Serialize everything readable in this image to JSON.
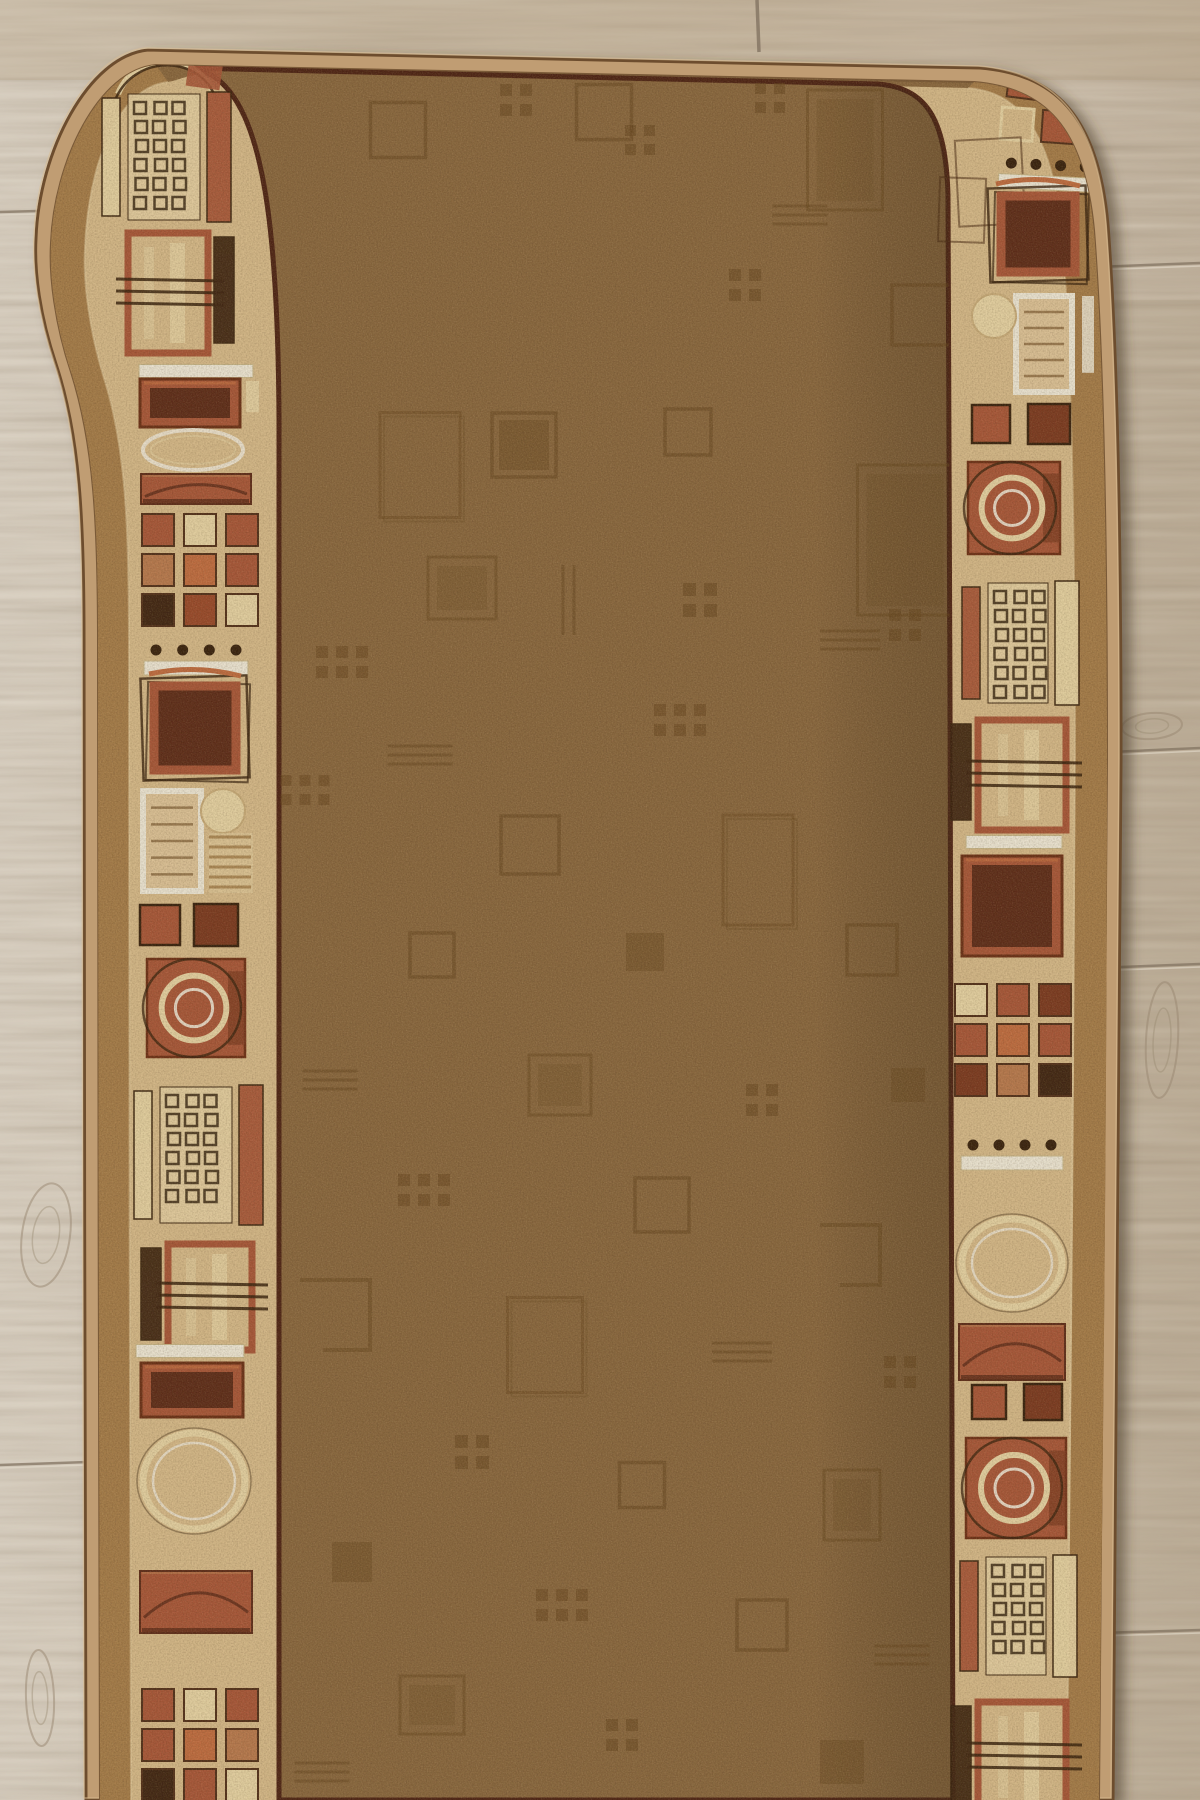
{
  "colors": {
    "woodBase": "#ccc0ae",
    "woodLight": "#ded5c6",
    "woodMid": "#c3b5a2",
    "woodWarm": "#c0ab90",
    "woodSeam": "#837462",
    "woodSeamHi": "#e9e1d2",
    "knot": "#97866f",
    "bindTan": "#c09d73",
    "bindEdge": "#6d4e2e",
    "bindHi": "#d9bd92",
    "gold": "#a67d4b",
    "beige": "#d7bb8c",
    "beigeLight": "#e5d0a4",
    "maroonLine": "#4e2416",
    "field": "#8a6840",
    "fieldMotif": "#66461f",
    "rust": "#a9573a",
    "rustLight": "#b97a50",
    "rustDark": "#7c3a22",
    "rustRed": "#9a4a2c",
    "maroonFill": "#5e2c1b",
    "orange": "#c16d42",
    "cream": "#e7d4a6",
    "darkbrown": "#402614",
    "white": "#efe9d9",
    "sketch": "#38220f",
    "shadow": "#4a3a26"
  },
  "wood": {
    "vseam": {
      "x": 757,
      "y1": 0,
      "y2": 52
    },
    "seams": [
      {
        "x1": 0,
        "y1": 212,
        "x2": 150,
        "y2": 208
      },
      {
        "x1": 0,
        "y1": 1465,
        "x2": 88,
        "y2": 1462
      },
      {
        "x1": 1095,
        "y1": 267,
        "x2": 1200,
        "y2": 263
      },
      {
        "x1": 1110,
        "y1": 752,
        "x2": 1200,
        "y2": 748
      },
      {
        "x1": 1120,
        "y1": 967,
        "x2": 1200,
        "y2": 964
      },
      {
        "x1": 1100,
        "y1": 1633,
        "x2": 1200,
        "y2": 1630
      }
    ],
    "knots": [
      {
        "cx": 46,
        "cy": 1235,
        "rx": 24,
        "ry": 52,
        "rot": 8
      },
      {
        "cx": 100,
        "cy": 116,
        "rx": 22,
        "ry": 10,
        "rot": -14
      },
      {
        "cx": 1152,
        "cy": 726,
        "rx": 30,
        "ry": 13,
        "rot": -4
      },
      {
        "cx": 1162,
        "cy": 1040,
        "rx": 16,
        "ry": 58,
        "rot": 3
      },
      {
        "cx": 40,
        "cy": 1698,
        "rx": 14,
        "ry": 48,
        "rot": -2
      }
    ]
  },
  "bandLeft": [
    {
      "t": "purse",
      "x": 163,
      "y": 72,
      "r": -5
    },
    {
      "t": "waffle",
      "x": 164,
      "y": 157,
      "w": 72,
      "h": 126,
      "bl": "cream",
      "br": "rust"
    },
    {
      "t": "rectlines",
      "x": 168,
      "y": 293,
      "w": 80,
      "h": 120,
      "br": "darkbrown"
    },
    {
      "t": "whitebar",
      "x": 196,
      "y": 371,
      "w": 114
    },
    {
      "t": "rustrect",
      "x": 190,
      "y": 403,
      "w": 100,
      "h": 48,
      "cb": true
    },
    {
      "t": "ellipseF",
      "x": 193,
      "y": 450,
      "rx": 50,
      "ry": 20
    },
    {
      "t": "bandm",
      "x": 196,
      "y": 489,
      "w": 110,
      "h": 30
    },
    {
      "t": "grid3",
      "x": 200,
      "y": 570,
      "s": 32,
      "rows": [
        [
          "rust",
          "cream",
          "rust"
        ],
        [
          "rustLight",
          "orange",
          "rust"
        ],
        [
          "darkbrown",
          "rustRed",
          "cream"
        ]
      ]
    },
    {
      "t": "dotsbar",
      "x": 196,
      "y": 655,
      "w": 80
    },
    {
      "t": "bigsquare",
      "x": 195,
      "y": 728,
      "w": 92
    },
    {
      "t": "docm",
      "x": 172,
      "y": 841,
      "w": 58,
      "h": 100,
      "side": "L"
    },
    {
      "t": "pairsq",
      "x": 188,
      "y": 925,
      "s": 40,
      "g": 16
    },
    {
      "t": "circlesm",
      "x": 196,
      "y": 1008,
      "s": 98
    },
    {
      "t": "waffle",
      "x": 196,
      "y": 1155,
      "w": 72,
      "h": 136,
      "bl": "cream",
      "br": "rust"
    },
    {
      "t": "rectlines",
      "x": 210,
      "y": 1297,
      "w": 84,
      "h": 106,
      "bl": "darkbrown"
    },
    {
      "t": "whitebar",
      "x": 190,
      "y": 1351,
      "w": 108
    },
    {
      "t": "rustrect",
      "x": 192,
      "y": 1390,
      "w": 102,
      "h": 54
    },
    {
      "t": "ellipseB",
      "x": 194,
      "y": 1481,
      "rx": 51,
      "ry": 48
    },
    {
      "t": "bandm",
      "x": 196,
      "y": 1602,
      "w": 112,
      "h": 62
    },
    {
      "t": "grid3",
      "x": 200,
      "y": 1745,
      "s": 32,
      "rows": [
        [
          "rust",
          "cream",
          "rust"
        ],
        [
          "rust",
          "orange",
          "rustLight"
        ],
        [
          "darkbrown",
          "rust",
          "cream"
        ]
      ]
    }
  ],
  "bandRight": [
    {
      "t": "sqrow",
      "x": 1062,
      "y": 88,
      "s": 30,
      "g": 9,
      "r": 7,
      "cols": [
        "rust",
        "orange",
        "rust"
      ]
    },
    {
      "t": "sqrow",
      "x": 1058,
      "y": 127,
      "s": 32,
      "g": 9,
      "r": 4,
      "cols": [
        "beigeOpen",
        "rust",
        "darkbrown"
      ]
    },
    {
      "t": "sketchrect",
      "x": 990,
      "y": 182,
      "w": 66,
      "h": 86,
      "r": -3
    },
    {
      "t": "sketchrect",
      "x": 962,
      "y": 210,
      "w": 46,
      "h": 64,
      "r": 2
    },
    {
      "t": "dotsbar",
      "x": 1048,
      "y": 170,
      "w": 74,
      "r": 3
    },
    {
      "t": "bigsquare",
      "x": 1038,
      "y": 234,
      "w": 84,
      "r": 2
    },
    {
      "t": "docm",
      "x": 1044,
      "y": 344,
      "w": 56,
      "h": 96,
      "side": "R"
    },
    {
      "t": "pairsq",
      "x": 1020,
      "y": 424,
      "s": 38,
      "g": 20
    },
    {
      "t": "circlesm",
      "x": 1014,
      "y": 508,
      "s": 92
    },
    {
      "t": "waffle",
      "x": 1018,
      "y": 643,
      "w": 60,
      "h": 120,
      "bl": "rust",
      "br": "cream"
    },
    {
      "t": "rectlines",
      "x": 1022,
      "y": 775,
      "w": 88,
      "h": 110,
      "bl": "darkbrown"
    },
    {
      "t": "whitebar",
      "x": 1014,
      "y": 842,
      "w": 96
    },
    {
      "t": "rustrect",
      "x": 1012,
      "y": 906,
      "w": 100,
      "h": 100
    },
    {
      "t": "grid3",
      "x": 1013,
      "y": 1040,
      "s": 32,
      "rows": [
        [
          "cream",
          "rust",
          "rustDark"
        ],
        [
          "rust",
          "orange",
          "rust"
        ],
        [
          "rustDark",
          "rustLight",
          "darkbrown"
        ]
      ]
    },
    {
      "t": "dotsbar",
      "x": 1012,
      "y": 1150,
      "w": 78
    },
    {
      "t": "ellipseB",
      "x": 1012,
      "y": 1263,
      "rx": 50,
      "ry": 44
    },
    {
      "t": "bandm",
      "x": 1012,
      "y": 1352,
      "w": 106,
      "h": 56
    },
    {
      "t": "pairsq",
      "x": 1016,
      "y": 1402,
      "s": 34,
      "g": 20
    },
    {
      "t": "circlesm",
      "x": 1016,
      "y": 1488,
      "s": 100
    },
    {
      "t": "waffle",
      "x": 1016,
      "y": 1616,
      "w": 60,
      "h": 118,
      "bl": "rust",
      "br": "cream"
    },
    {
      "t": "rectlines",
      "x": 1022,
      "y": 1757,
      "w": 88,
      "h": 110,
      "bl": "darkbrown"
    }
  ],
  "fieldMotifs": [
    {
      "t": "osq",
      "x": 398,
      "y": 130,
      "s": 55
    },
    {
      "t": "dots4",
      "x": 516,
      "y": 100,
      "s": 12
    },
    {
      "t": "osq",
      "x": 604,
      "y": 112,
      "s": 55
    },
    {
      "t": "dots4",
      "x": 640,
      "y": 140,
      "s": 11
    },
    {
      "t": "dots4",
      "x": 770,
      "y": 98,
      "s": 11
    },
    {
      "t": "osq2",
      "x": 845,
      "y": 150,
      "w": 75,
      "h": 120
    },
    {
      "t": "hdash",
      "x": 800,
      "y": 215,
      "w": 55
    },
    {
      "t": "dots4",
      "x": 745,
      "y": 285,
      "s": 12
    },
    {
      "t": "osq",
      "x": 922,
      "y": 315,
      "s": 60
    },
    {
      "t": "lrect",
      "x": 420,
      "y": 465,
      "w": 80,
      "h": 105
    },
    {
      "t": "fsq",
      "x": 524,
      "y": 445,
      "s": 50
    },
    {
      "t": "osq",
      "x": 524,
      "y": 445,
      "s": 64
    },
    {
      "t": "osq",
      "x": 688,
      "y": 432,
      "s": 46
    },
    {
      "t": "osq2",
      "x": 905,
      "y": 540,
      "w": 95,
      "h": 150
    },
    {
      "t": "osq2",
      "x": 462,
      "y": 588,
      "w": 68,
      "h": 62
    },
    {
      "t": "vdash",
      "x": 568,
      "y": 600,
      "h": 70
    },
    {
      "t": "dots4",
      "x": 700,
      "y": 600,
      "s": 13
    },
    {
      "t": "hdash",
      "x": 850,
      "y": 640,
      "w": 60
    },
    {
      "t": "dots6",
      "x": 342,
      "y": 662,
      "s": 12
    },
    {
      "t": "dots6",
      "x": 680,
      "y": 720,
      "s": 12
    },
    {
      "t": "hdash",
      "x": 420,
      "y": 755,
      "w": 65
    },
    {
      "t": "dots6",
      "x": 305,
      "y": 790,
      "s": 11
    },
    {
      "t": "osq",
      "x": 530,
      "y": 845,
      "s": 58
    },
    {
      "t": "lrect",
      "x": 758,
      "y": 870,
      "w": 70,
      "h": 110
    },
    {
      "t": "dots4",
      "x": 905,
      "y": 625,
      "s": 12
    },
    {
      "t": "osq",
      "x": 432,
      "y": 955,
      "s": 44
    },
    {
      "t": "fsq",
      "x": 645,
      "y": 952,
      "s": 38
    },
    {
      "t": "osq",
      "x": 872,
      "y": 950,
      "s": 50
    },
    {
      "t": "hdash",
      "x": 330,
      "y": 1080,
      "w": 55
    },
    {
      "t": "osq2",
      "x": 560,
      "y": 1085,
      "w": 62,
      "h": 60
    },
    {
      "t": "dots4",
      "x": 762,
      "y": 1100,
      "s": 12
    },
    {
      "t": "fsq",
      "x": 908,
      "y": 1085,
      "s": 34
    },
    {
      "t": "dots6",
      "x": 424,
      "y": 1190,
      "s": 12
    },
    {
      "t": "osq",
      "x": 662,
      "y": 1205,
      "s": 54
    },
    {
      "t": "bracket",
      "x": 850,
      "y": 1255,
      "s": 60
    },
    {
      "t": "bracket",
      "x": 335,
      "y": 1315,
      "s": 70
    },
    {
      "t": "lrect",
      "x": 545,
      "y": 1345,
      "w": 75,
      "h": 95
    },
    {
      "t": "hdash",
      "x": 742,
      "y": 1352,
      "w": 60
    },
    {
      "t": "dots4",
      "x": 900,
      "y": 1372,
      "s": 12
    },
    {
      "t": "dots4",
      "x": 472,
      "y": 1452,
      "s": 13
    },
    {
      "t": "osq",
      "x": 642,
      "y": 1485,
      "s": 45
    },
    {
      "t": "osq2",
      "x": 852,
      "y": 1505,
      "w": 56,
      "h": 70
    },
    {
      "t": "fsq",
      "x": 352,
      "y": 1562,
      "s": 40
    },
    {
      "t": "dots6",
      "x": 562,
      "y": 1605,
      "s": 12
    },
    {
      "t": "osq",
      "x": 762,
      "y": 1625,
      "s": 50
    },
    {
      "t": "hdash",
      "x": 902,
      "y": 1655,
      "w": 55
    },
    {
      "t": "osq2",
      "x": 432,
      "y": 1705,
      "w": 64,
      "h": 58
    },
    {
      "t": "dots4",
      "x": 622,
      "y": 1735,
      "s": 12
    },
    {
      "t": "hdash",
      "x": 322,
      "y": 1772,
      "w": 55
    },
    {
      "t": "fsq",
      "x": 842,
      "y": 1762,
      "s": 44
    }
  ]
}
